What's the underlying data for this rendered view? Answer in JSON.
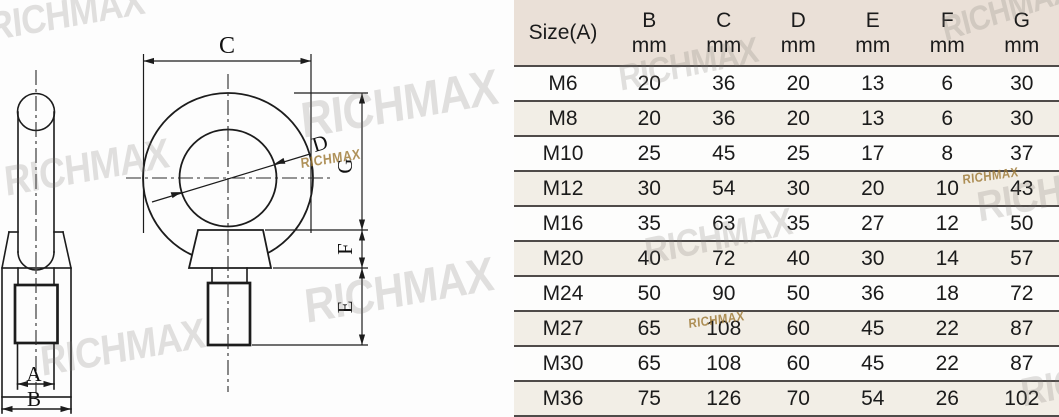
{
  "table": {
    "header": {
      "size_label": "Size(A)",
      "columns": [
        {
          "name": "B",
          "unit": "mm"
        },
        {
          "name": "C",
          "unit": "mm"
        },
        {
          "name": "D",
          "unit": "mm"
        },
        {
          "name": "E",
          "unit": "mm"
        },
        {
          "name": "F",
          "unit": "mm"
        },
        {
          "name": "G",
          "unit": "mm"
        }
      ]
    },
    "rows": [
      {
        "size": "M6",
        "values": [
          "20",
          "36",
          "20",
          "13",
          "6",
          "30"
        ]
      },
      {
        "size": "M8",
        "values": [
          "20",
          "36",
          "20",
          "13",
          "6",
          "30"
        ]
      },
      {
        "size": "M10",
        "values": [
          "25",
          "45",
          "25",
          "17",
          "8",
          "37"
        ]
      },
      {
        "size": "M12",
        "values": [
          "30",
          "54",
          "30",
          "20",
          "10",
          "43"
        ]
      },
      {
        "size": "M16",
        "values": [
          "35",
          "63",
          "35",
          "27",
          "12",
          "50"
        ]
      },
      {
        "size": "M20",
        "values": [
          "40",
          "72",
          "40",
          "30",
          "14",
          "57"
        ]
      },
      {
        "size": "M24",
        "values": [
          "50",
          "90",
          "50",
          "36",
          "18",
          "72"
        ]
      },
      {
        "size": "M27",
        "values": [
          "65",
          "108",
          "60",
          "45",
          "22",
          "87"
        ]
      },
      {
        "size": "M30",
        "values": [
          "65",
          "108",
          "60",
          "45",
          "22",
          "87"
        ]
      },
      {
        "size": "M36",
        "values": [
          "75",
          "126",
          "70",
          "54",
          "26",
          "102"
        ]
      }
    ]
  },
  "drawing": {
    "labels": {
      "A": "A",
      "B": "B",
      "C": "C",
      "D": "D",
      "E": "E",
      "F": "F",
      "G": "G"
    }
  },
  "watermark": {
    "text": "RICHMAX",
    "gray_color": "rgba(122,117,112,0.22)",
    "gold_color": "rgba(158,121,52,0.82)",
    "instances": [
      {
        "x": -14,
        "y": 6,
        "size": 40,
        "rot": -10,
        "kind": "gray"
      },
      {
        "x": 2,
        "y": 158,
        "size": 42,
        "rot": -10,
        "kind": "gray"
      },
      {
        "x": 38,
        "y": 338,
        "size": 42,
        "rot": -10,
        "kind": "gray"
      },
      {
        "x": 298,
        "y": 92,
        "size": 50,
        "rot": -10,
        "kind": "gray"
      },
      {
        "x": 302,
        "y": 280,
        "size": 48,
        "rot": -10,
        "kind": "gray"
      },
      {
        "x": 300,
        "y": 155,
        "size": 14,
        "rot": -9,
        "kind": "gold"
      },
      {
        "x": 938,
        "y": 12,
        "size": 34,
        "rot": -18,
        "kind": "gray"
      },
      {
        "x": 616,
        "y": 58,
        "size": 36,
        "rot": -12,
        "kind": "gray"
      },
      {
        "x": 642,
        "y": 232,
        "size": 38,
        "rot": -12,
        "kind": "gray"
      },
      {
        "x": 974,
        "y": 184,
        "size": 42,
        "rot": -12,
        "kind": "gray"
      },
      {
        "x": 1018,
        "y": 372,
        "size": 40,
        "rot": -12,
        "kind": "gray"
      },
      {
        "x": 962,
        "y": 172,
        "size": 13,
        "rot": -8,
        "kind": "gold"
      },
      {
        "x": 688,
        "y": 316,
        "size": 13,
        "rot": -8,
        "kind": "gold"
      }
    ]
  },
  "colors": {
    "header_bg": "#eae0d7",
    "row_alt_bg": "#f2eee6",
    "row_bg": "#fdfdfc",
    "separator": "#4f4b49",
    "line": "#1c1c1c"
  }
}
